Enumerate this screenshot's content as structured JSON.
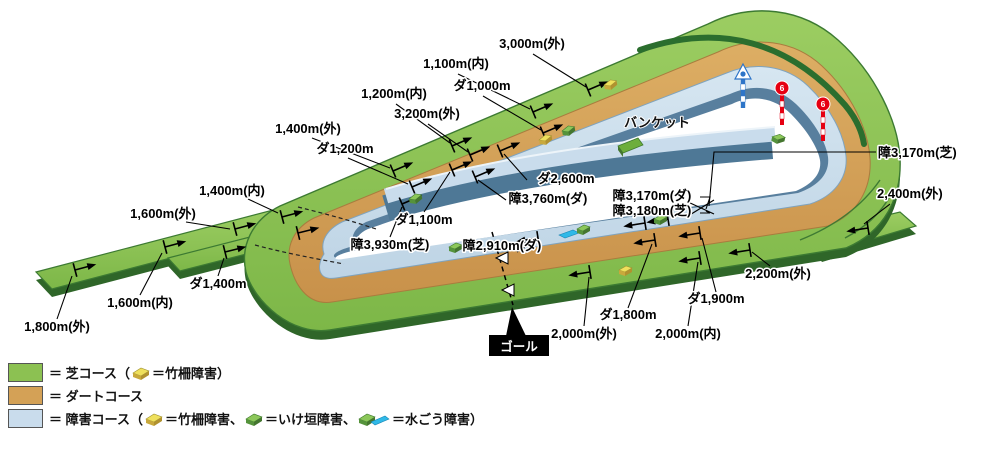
{
  "course_labels": [
    "1,800m(外)",
    "1,600m(内)",
    "ダ1,400m",
    "1,600m(外)",
    "1,400m(内)",
    "1,400m(外)",
    "ダ1,200m",
    "1,200m(内)",
    "3,200m(外)",
    "1,100m(内)",
    "ダ1,000m",
    "3,000m(外)",
    "バンケット",
    "ダ2,600m",
    "障3,760m(ダ)",
    "ダ1,100m",
    "障3,930m(芝)",
    "障2,910m(ダ)",
    "障3,170m(ダ)",
    "障3,180m(芝)",
    "障3,170m(芝)",
    "2,400m(外)",
    "2,200m(外)",
    "ダ1,900m",
    "ダ1,800m",
    "2,000m(外)",
    "2,000m(内)"
  ],
  "goal_label": "ゴール",
  "poles": {
    "red_digit": "6"
  },
  "legend": {
    "rows": [
      {
        "p1": "＝ 芝コース（",
        "p2": "＝竹柵障害）"
      },
      {
        "p1": "＝ ダートコース"
      },
      {
        "p1": "＝ 障害コース（",
        "p2": "＝竹柵障害、",
        "p3": "＝いけ垣障害、",
        "p4": "＝水ごう障害）"
      }
    ]
  },
  "colors": {
    "turf": "#8CC152",
    "turf_dark": "#2F6629",
    "dirt": "#D4A156",
    "jump": "#C9DCEC",
    "jump_wall": "#587F9E",
    "water": "#2FB9E8",
    "bamboo": "#EBD851",
    "hedge": "#6FAE3E"
  }
}
